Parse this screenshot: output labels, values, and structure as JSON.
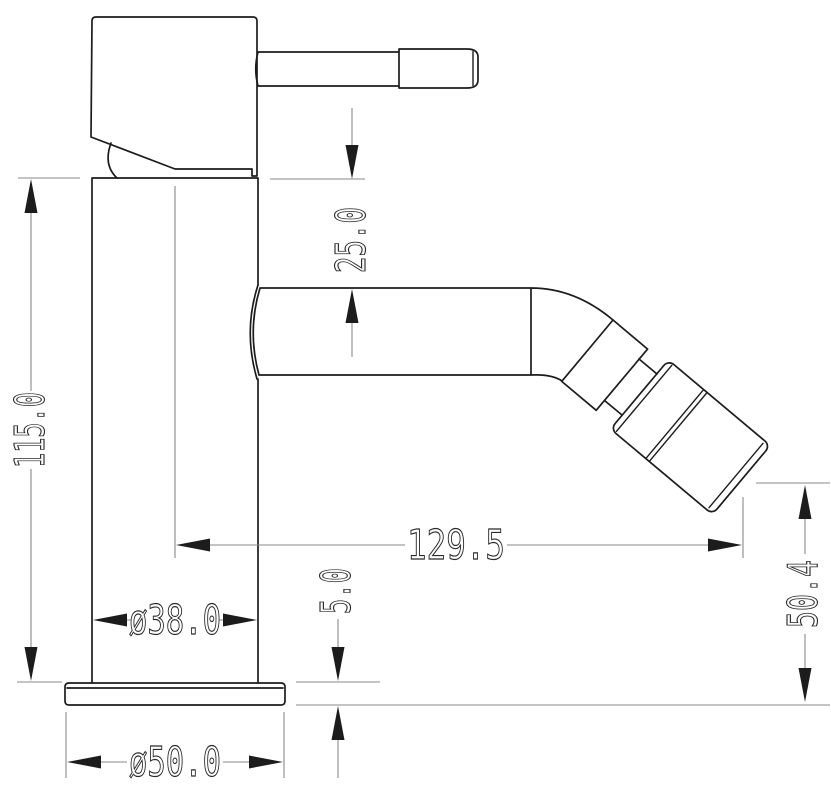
{
  "drawing": {
    "subject": "bidet-mixer-tap-side-elevation",
    "units": "mm",
    "background": "#ffffff",
    "colors": {
      "outline": "#1c1c1c",
      "dimension_lines": "#8a8a8a",
      "text": "#2a2a2a"
    },
    "dimensions": {
      "handle_to_spout_drop": {
        "label": "25.0",
        "orientation": "vertical"
      },
      "body_height": {
        "label": "115.0",
        "orientation": "vertical"
      },
      "spout_reach": {
        "label": "129.5",
        "orientation": "horizontal"
      },
      "body_diameter": {
        "label": "ø38.0",
        "orientation": "horizontal"
      },
      "base_diameter": {
        "label": "ø50.0",
        "orientation": "horizontal"
      },
      "base_plate_thickness": {
        "label": "5.0",
        "orientation": "vertical"
      },
      "outlet_height": {
        "label": "50.4",
        "orientation": "vertical"
      }
    }
  }
}
